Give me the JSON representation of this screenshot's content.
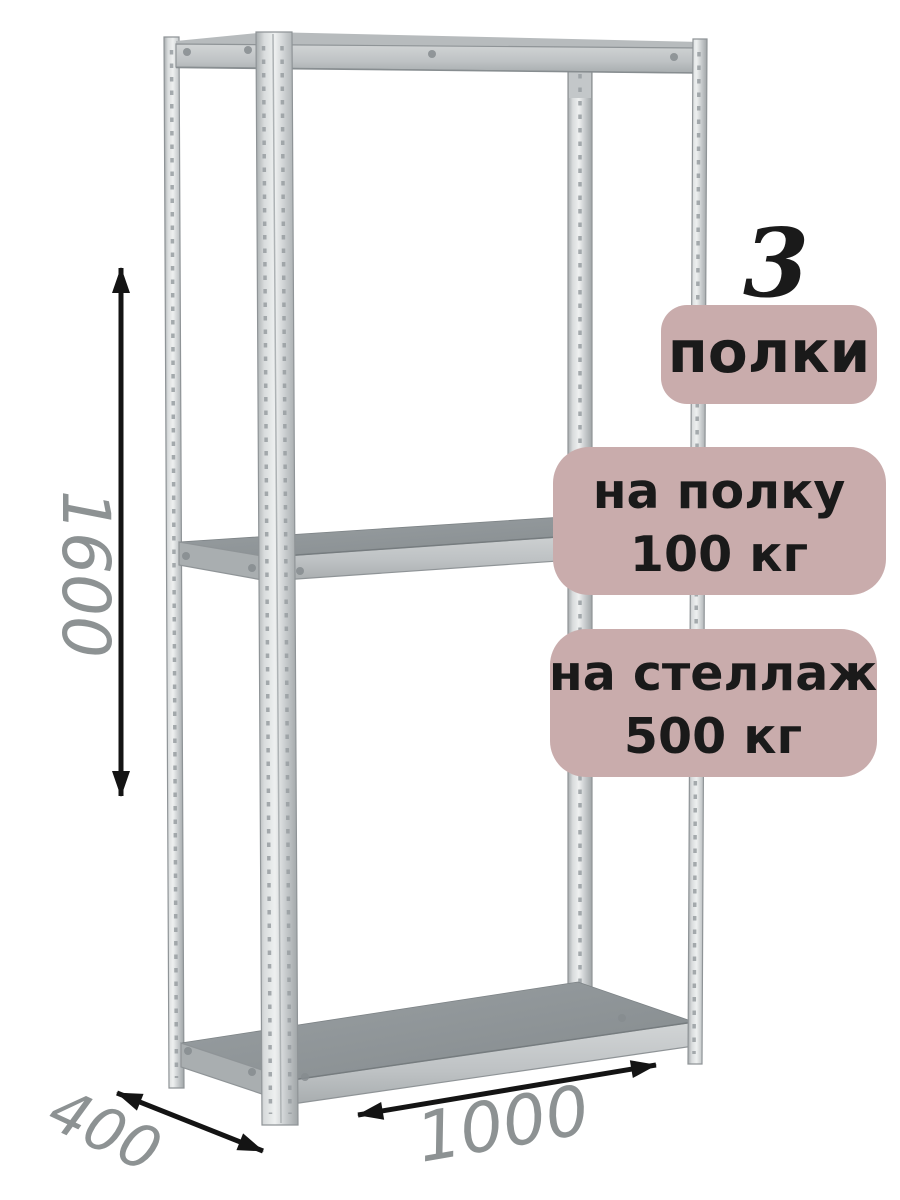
{
  "product": {
    "shelf_count": "3",
    "shelf_count_unit": "полки",
    "per_shelf_load_line1": "на полку",
    "per_shelf_load_line2": "100 кг",
    "total_load_line1": "на стеллаж",
    "total_load_line2": "500 кг"
  },
  "dimensions": {
    "height_mm": "1600",
    "width_mm": "1000",
    "depth_mm": "400"
  },
  "colors": {
    "background": "#ffffff",
    "badge_fill": "#c9acac",
    "badge_text": "#1a1a1a",
    "dimension_text": "#8d9293",
    "arrow": "#141414"
  }
}
